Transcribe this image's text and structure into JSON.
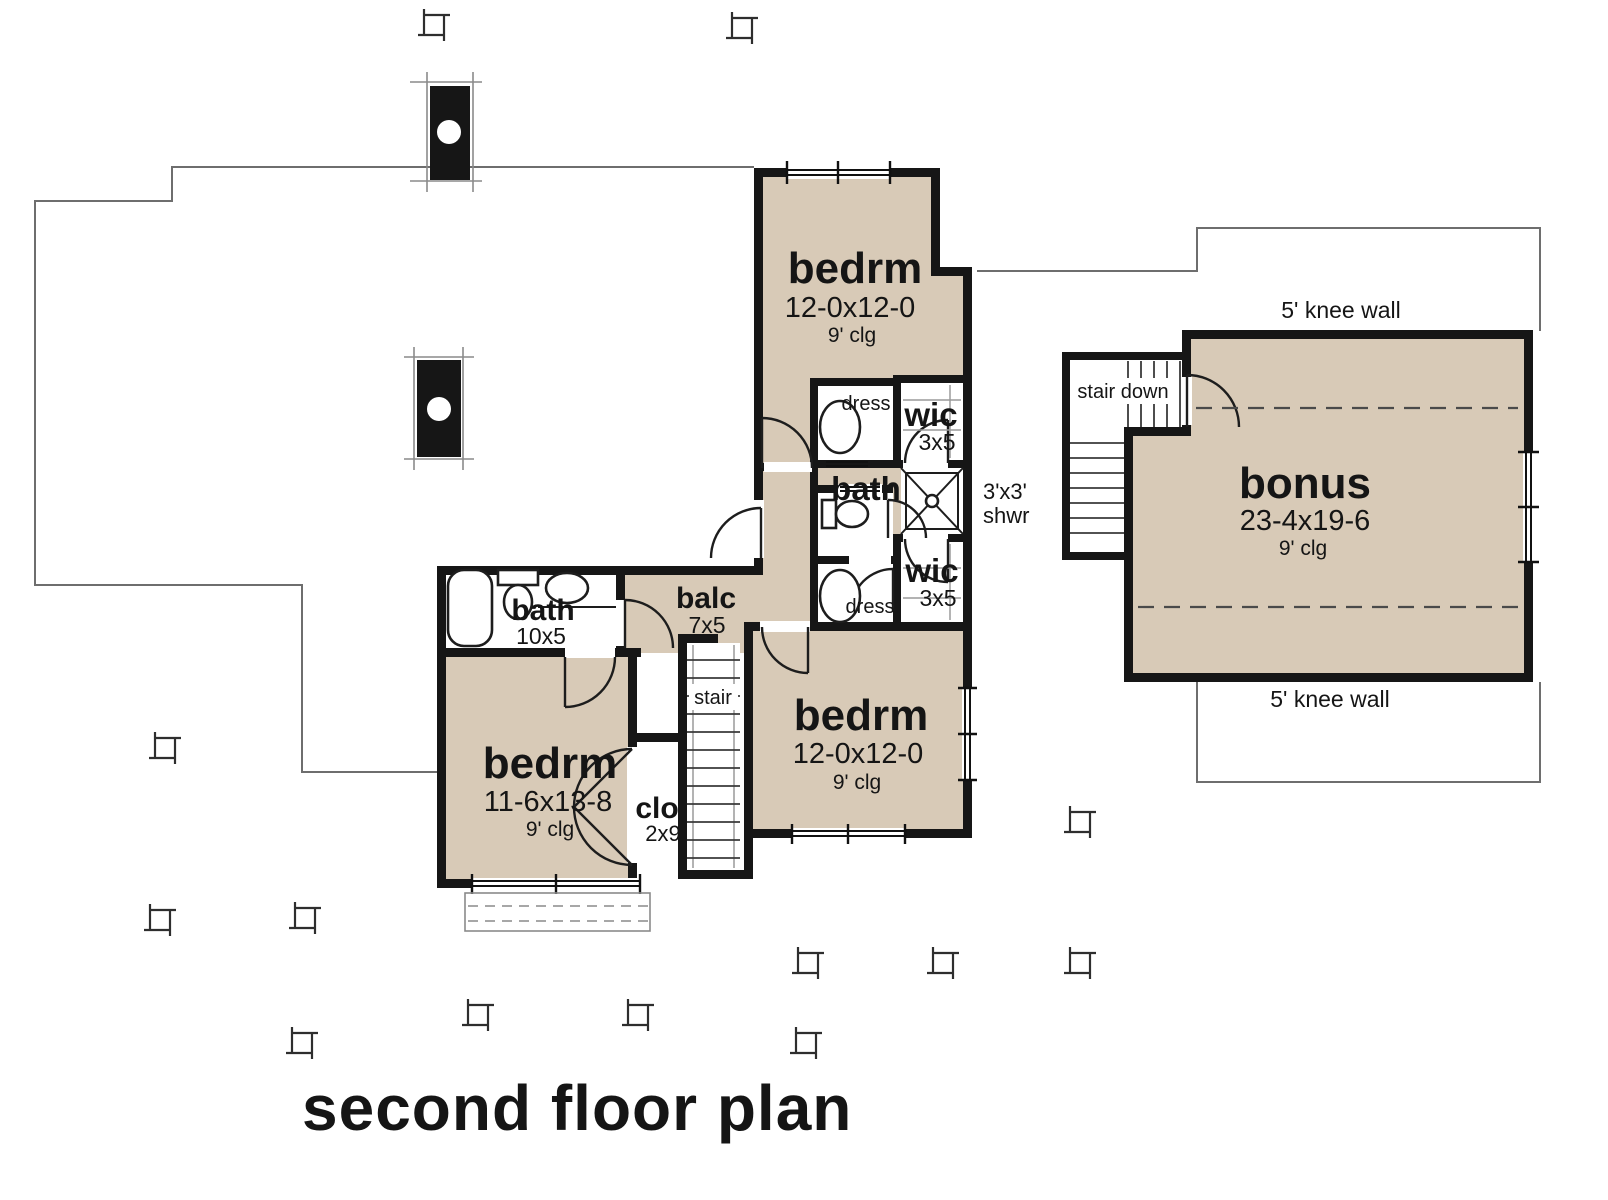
{
  "title": {
    "text": "second floor plan"
  },
  "rooms": {
    "bedroom_upper": {
      "name": "bedrm",
      "dims": "12-0x12-0",
      "ceiling": "9' clg"
    },
    "bedroom_right": {
      "name": "bedrm",
      "dims": "12-0x12-0",
      "ceiling": "9' clg"
    },
    "bedroom_left": {
      "name": "bedrm",
      "dims": "11-6x13-8",
      "ceiling": "9' clg"
    },
    "bonus": {
      "name": "bonus",
      "dims": "23-4x19-6",
      "ceiling": "9' clg"
    },
    "bath_hall": {
      "name": "bath"
    },
    "bath_left": {
      "name": "bath",
      "dims": "10x5"
    },
    "balcony": {
      "name": "balc",
      "dims": "7x5"
    },
    "wic_upper": {
      "name": "wic",
      "dims": "3x5"
    },
    "wic_lower": {
      "name": "wic",
      "dims": "3x5"
    },
    "dress_upper": {
      "name": "dress"
    },
    "dress_lower": {
      "name": "dress"
    },
    "closet": {
      "name": "clo",
      "dims": "2x9"
    },
    "stair": {
      "name": "stair"
    },
    "stair_down": {
      "name": "stair down"
    },
    "shower": {
      "line1": "3'x3'",
      "line2": "shwr"
    }
  },
  "annotations": {
    "knee_wall_top": "5' knee wall",
    "knee_wall_bottom": "5' knee wall"
  },
  "colors": {
    "floor_fill": "#d8cab7",
    "wall": "#161616",
    "reference_line": "#6e6e6e",
    "background": "#ffffff"
  }
}
